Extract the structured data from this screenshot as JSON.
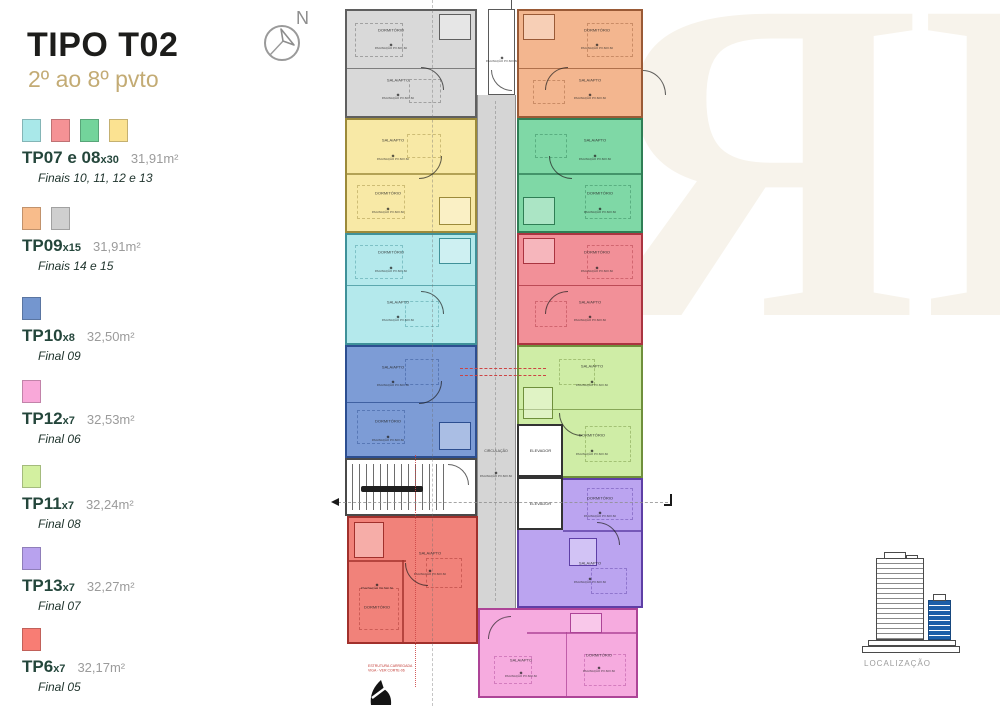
{
  "header": {
    "title": "TIPO T02",
    "subtitle": "2º ao 8º pvto"
  },
  "compass": {
    "label": "N"
  },
  "legend": [
    {
      "code": "TP07 e 08",
      "mult": "x30",
      "area": "31,91m²",
      "finals": "Finais 10, 11, 12 e 13",
      "colors": [
        "#a9e8e9",
        "#f59295",
        "#73d49b",
        "#fbe291"
      ]
    },
    {
      "code": "TP09",
      "mult": "x15",
      "area": "31,91m²",
      "finals": "Finais 14 e 15",
      "colors": [
        "#f8bc8b",
        "#cfcfcf"
      ]
    },
    {
      "code": "TP10",
      "mult": "x8",
      "area": "32,50m²",
      "finals": "Final 09",
      "colors": [
        "#7496cf"
      ]
    },
    {
      "code": "TP12",
      "mult": "x7",
      "area": "32,53m²",
      "finals": "Final 06",
      "colors": [
        "#f9a8d9"
      ]
    },
    {
      "code": "TP11",
      "mult": "x7",
      "area": "32,24m²",
      "finals": "Final 08",
      "colors": [
        "#d3f0a0"
      ]
    },
    {
      "code": "TP13",
      "mult": "x7",
      "area": "32,27m²",
      "finals": "Final 07",
      "colors": [
        "#b8a2ee"
      ]
    },
    {
      "code": "TP6",
      "mult": "x7",
      "area": "32,17m²",
      "finals": "Final 05",
      "colors": [
        "#f87d74"
      ]
    }
  ],
  "plan": {
    "labels": {
      "sala": "SALA/APTO",
      "dorm": "DORMITÓRIO",
      "tile": "PAGINAÇÃO PX.60X.60",
      "corridor": "CIRCULAÇÃO",
      "elevator": "ELEVADOR"
    },
    "units": [
      {
        "name": "gray",
        "fill": "#d9d9d9",
        "wall": "#5f5f5f"
      },
      {
        "name": "yellow",
        "fill": "#f8e9a6",
        "wall": "#9c8a3a"
      },
      {
        "name": "cyan",
        "fill": "#b4e9ec",
        "wall": "#3f9199"
      },
      {
        "name": "blue",
        "fill": "#7d9cd6",
        "wall": "#2c4e90"
      },
      {
        "name": "orange",
        "fill": "#f3b68f",
        "wall": "#9a5a36"
      },
      {
        "name": "green",
        "fill": "#7fd8a6",
        "wall": "#2f7e55"
      },
      {
        "name": "salmon",
        "fill": "#f29098",
        "wall": "#aa3440"
      },
      {
        "name": "lightgreen",
        "fill": "#cfeda6",
        "wall": "#6f8f3c"
      },
      {
        "name": "purple",
        "fill": "#bba4f0",
        "wall": "#5e3fa6"
      },
      {
        "name": "pink",
        "fill": "#f6abdf",
        "wall": "#ad4497"
      },
      {
        "name": "red",
        "fill": "#f1827a",
        "wall": "#a1302c"
      }
    ]
  },
  "annotation": {
    "line1": "ESTRUTURA CARREGADA",
    "line2": "VIGA - VER CORTE-06"
  },
  "watermark": {
    "letter": "R",
    "color": "#f7f3eb"
  },
  "localizacao": {
    "label": "LOCALIZAÇÃO"
  }
}
